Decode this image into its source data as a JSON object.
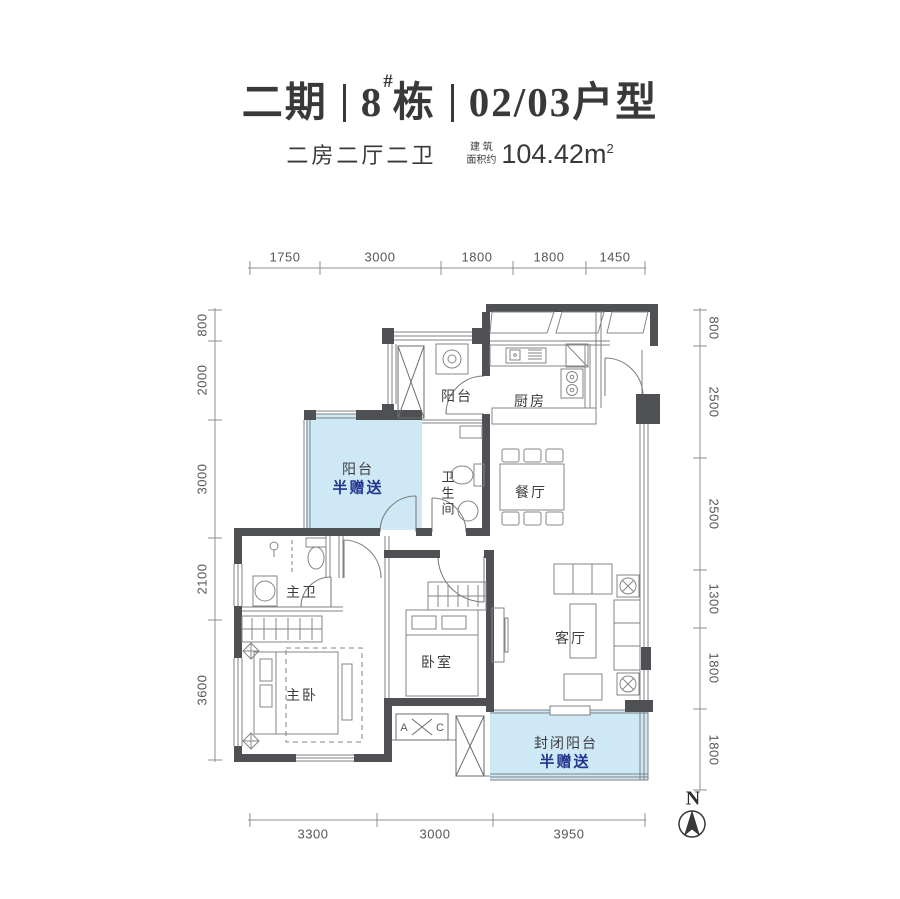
{
  "header": {
    "title": {
      "phase": "二期",
      "building_number": "8",
      "building_sup": "#",
      "building_word": "栋",
      "unit_type": "02/03户型"
    },
    "subtitle": {
      "layout": "二房二厅二卫",
      "area_label_line1": "建 筑",
      "area_label_line2": "面积约",
      "area_value": "104.42",
      "area_unit": "m",
      "area_exponent": "2"
    }
  },
  "rooms": {
    "balcony_top": "阳台",
    "kitchen": "厨房",
    "bathroom": "卫生间",
    "dining": "餐厅",
    "gift_balcony_name": "阳台",
    "gift_balcony_tag": "半赠送",
    "master_bath": "主卫",
    "master_bedroom": "主卧",
    "bedroom": "卧室",
    "living": "客厅",
    "enclosed_balcony_name": "封闭阳台",
    "enclosed_balcony_tag": "半赠送"
  },
  "plan": {
    "ac_label_left": "A",
    "ac_label_right": "C"
  },
  "dimensions": {
    "top": [
      "1750",
      "3000",
      "1800",
      "1800",
      "1450"
    ],
    "bottom": [
      "3300",
      "3000",
      "3950"
    ],
    "left": [
      "800",
      "2000",
      "3000",
      "2100",
      "3600"
    ],
    "right": [
      "800",
      "2500",
      "2500",
      "1300",
      "1800",
      "1800"
    ]
  },
  "compass": {
    "north": "N"
  },
  "colors": {
    "gift_fill": "#cfe8f5",
    "gift_text": "#23368e",
    "wall": "#4f5053",
    "ink": "#39383a"
  }
}
